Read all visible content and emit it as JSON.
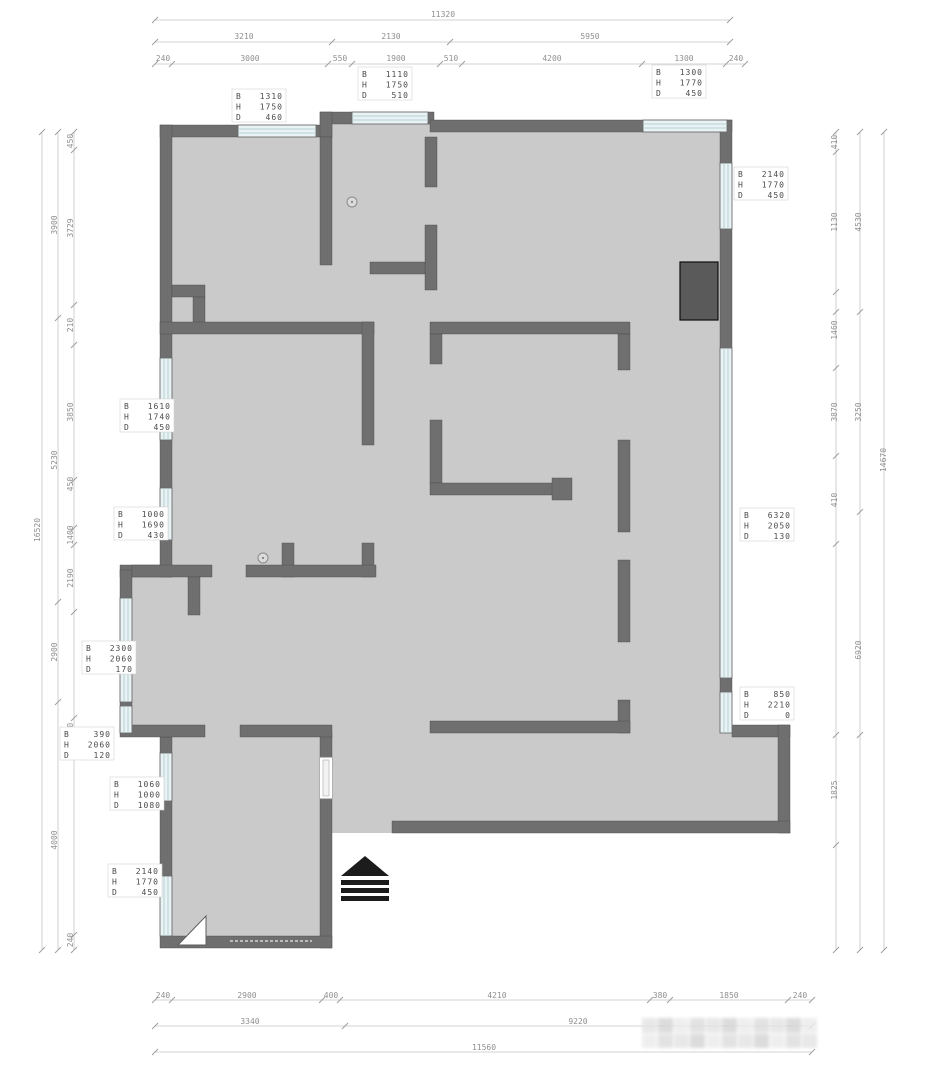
{
  "drawing": {
    "type": "apartment-floor-plan",
    "wall_color": "#6f6f6f",
    "floor_color": "#cacaca",
    "window_color": "#e9f2f4",
    "accent_dark": "#1c1c1c"
  },
  "window_labels": [
    {
      "b": "1310",
      "h": "1750",
      "d": "460",
      "x": 232,
      "y": 89
    },
    {
      "b": "1110",
      "h": "1750",
      "d": "510",
      "x": 358,
      "y": 67
    },
    {
      "b": "1300",
      "h": "1770",
      "d": "450",
      "x": 652,
      "y": 65
    },
    {
      "b": "2140",
      "h": "1770",
      "d": "450",
      "x": 734,
      "y": 167
    },
    {
      "b": "6320",
      "h": "2050",
      "d": "130",
      "x": 740,
      "y": 508
    },
    {
      "b": "850",
      "h": "2210",
      "d": "0",
      "x": 740,
      "y": 687
    },
    {
      "b": "1610",
      "h": "1740",
      "d": "450",
      "x": 120,
      "y": 399
    },
    {
      "b": "1000",
      "h": "1690",
      "d": "430",
      "x": 114,
      "y": 507
    },
    {
      "b": "2300",
      "h": "2060",
      "d": "170",
      "x": 82,
      "y": 641
    },
    {
      "b": "390",
      "h": "2060",
      "d": "120",
      "x": 60,
      "y": 727
    },
    {
      "b": "1060",
      "h": "1000",
      "d": "1080",
      "x": 110,
      "y": 777
    },
    {
      "b": "2140",
      "h": "1770",
      "d": "450",
      "x": 108,
      "y": 864
    }
  ],
  "dimensions": {
    "top": [
      {
        "t": "11320",
        "x": 443,
        "y": 17
      },
      {
        "t": "3210",
        "x": 244,
        "y": 39
      },
      {
        "t": "2130",
        "x": 391,
        "y": 39
      },
      {
        "t": "5950",
        "x": 590,
        "y": 39
      },
      {
        "t": "240",
        "x": 163,
        "y": 61
      },
      {
        "t": "3000",
        "x": 250,
        "y": 61
      },
      {
        "t": "550",
        "x": 340,
        "y": 61
      },
      {
        "t": "1900",
        "x": 396,
        "y": 61
      },
      {
        "t": "510",
        "x": 451,
        "y": 61
      },
      {
        "t": "4200",
        "x": 552,
        "y": 61
      },
      {
        "t": "1300",
        "x": 684,
        "y": 61
      },
      {
        "t": "240",
        "x": 736,
        "y": 61
      }
    ],
    "bottom": [
      {
        "t": "240",
        "x": 163,
        "y": 998
      },
      {
        "t": "2900",
        "x": 247,
        "y": 998
      },
      {
        "t": "400",
        "x": 331,
        "y": 998
      },
      {
        "t": "4210",
        "x": 497,
        "y": 998
      },
      {
        "t": "380",
        "x": 660,
        "y": 998
      },
      {
        "t": "1850",
        "x": 729,
        "y": 998
      },
      {
        "t": "240",
        "x": 800,
        "y": 998
      },
      {
        "t": "3340",
        "x": 250,
        "y": 1024
      },
      {
        "t": "9220",
        "x": 578,
        "y": 1024
      },
      {
        "t": "11560",
        "x": 484,
        "y": 1050
      }
    ],
    "left": [
      {
        "t": "450",
        "x": 73,
        "y": 141,
        "r": 1
      },
      {
        "t": "3729",
        "x": 73,
        "y": 228,
        "r": 1
      },
      {
        "t": "210",
        "x": 73,
        "y": 325,
        "r": 1
      },
      {
        "t": "3850",
        "x": 73,
        "y": 412,
        "r": 1
      },
      {
        "t": "450",
        "x": 73,
        "y": 484,
        "r": 1
      },
      {
        "t": "1400",
        "x": 73,
        "y": 535,
        "r": 1
      },
      {
        "t": "2190",
        "x": 73,
        "y": 578,
        "r": 1
      },
      {
        "t": "400",
        "x": 73,
        "y": 730,
        "r": 1
      },
      {
        "t": "240",
        "x": 73,
        "y": 940,
        "r": 1
      },
      {
        "t": "3900",
        "x": 57,
        "y": 225,
        "r": 1
      },
      {
        "t": "5230",
        "x": 57,
        "y": 460,
        "r": 1
      },
      {
        "t": "2900",
        "x": 57,
        "y": 652,
        "r": 1
      },
      {
        "t": "4000",
        "x": 57,
        "y": 840,
        "r": 1
      },
      {
        "t": "16520",
        "x": 40,
        "y": 530,
        "r": 1
      }
    ],
    "right": [
      {
        "t": "410",
        "x": 837,
        "y": 142,
        "r": 1
      },
      {
        "t": "1130",
        "x": 837,
        "y": 222,
        "r": 1
      },
      {
        "t": "1460",
        "x": 837,
        "y": 330,
        "r": 1
      },
      {
        "t": "3870",
        "x": 837,
        "y": 412,
        "r": 1
      },
      {
        "t": "410",
        "x": 837,
        "y": 500,
        "r": 1
      },
      {
        "t": "1825",
        "x": 837,
        "y": 790,
        "r": 1
      },
      {
        "t": "4530",
        "x": 861,
        "y": 222,
        "r": 1
      },
      {
        "t": "3250",
        "x": 861,
        "y": 412,
        "r": 1
      },
      {
        "t": "6920",
        "x": 861,
        "y": 650,
        "r": 1
      },
      {
        "t": "14670",
        "x": 886,
        "y": 460,
        "r": 1
      }
    ]
  }
}
